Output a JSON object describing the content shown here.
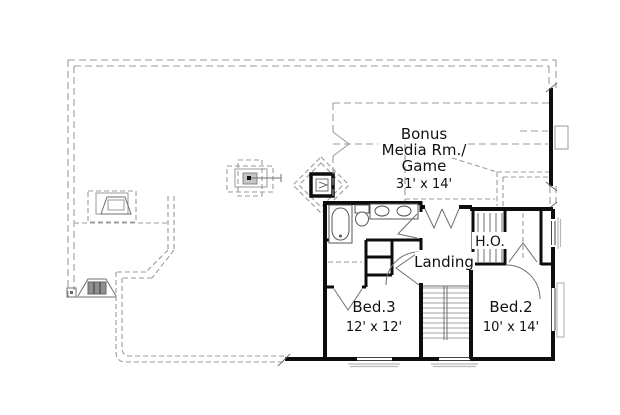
{
  "labels": {
    "bonus_room": {
      "line1": "Bonus",
      "line2": "Media Rm./",
      "line3": "Game",
      "dims": "31' x 14'"
    },
    "ho": "H.O.",
    "landing": "Landing",
    "bed3": {
      "name": "Bed.3",
      "dims": "12' x 12'"
    },
    "bed2": {
      "name": "Bed.2",
      "dims": "10' x 14'"
    }
  },
  "colors": {
    "background": "#ffffff",
    "wall": "#0d0d0d",
    "dashed": "#9b9b9b",
    "thin": "#6f6f6f",
    "tread": "#b4b4b4",
    "seat": "#8f8f8f",
    "text": "#111111"
  }
}
